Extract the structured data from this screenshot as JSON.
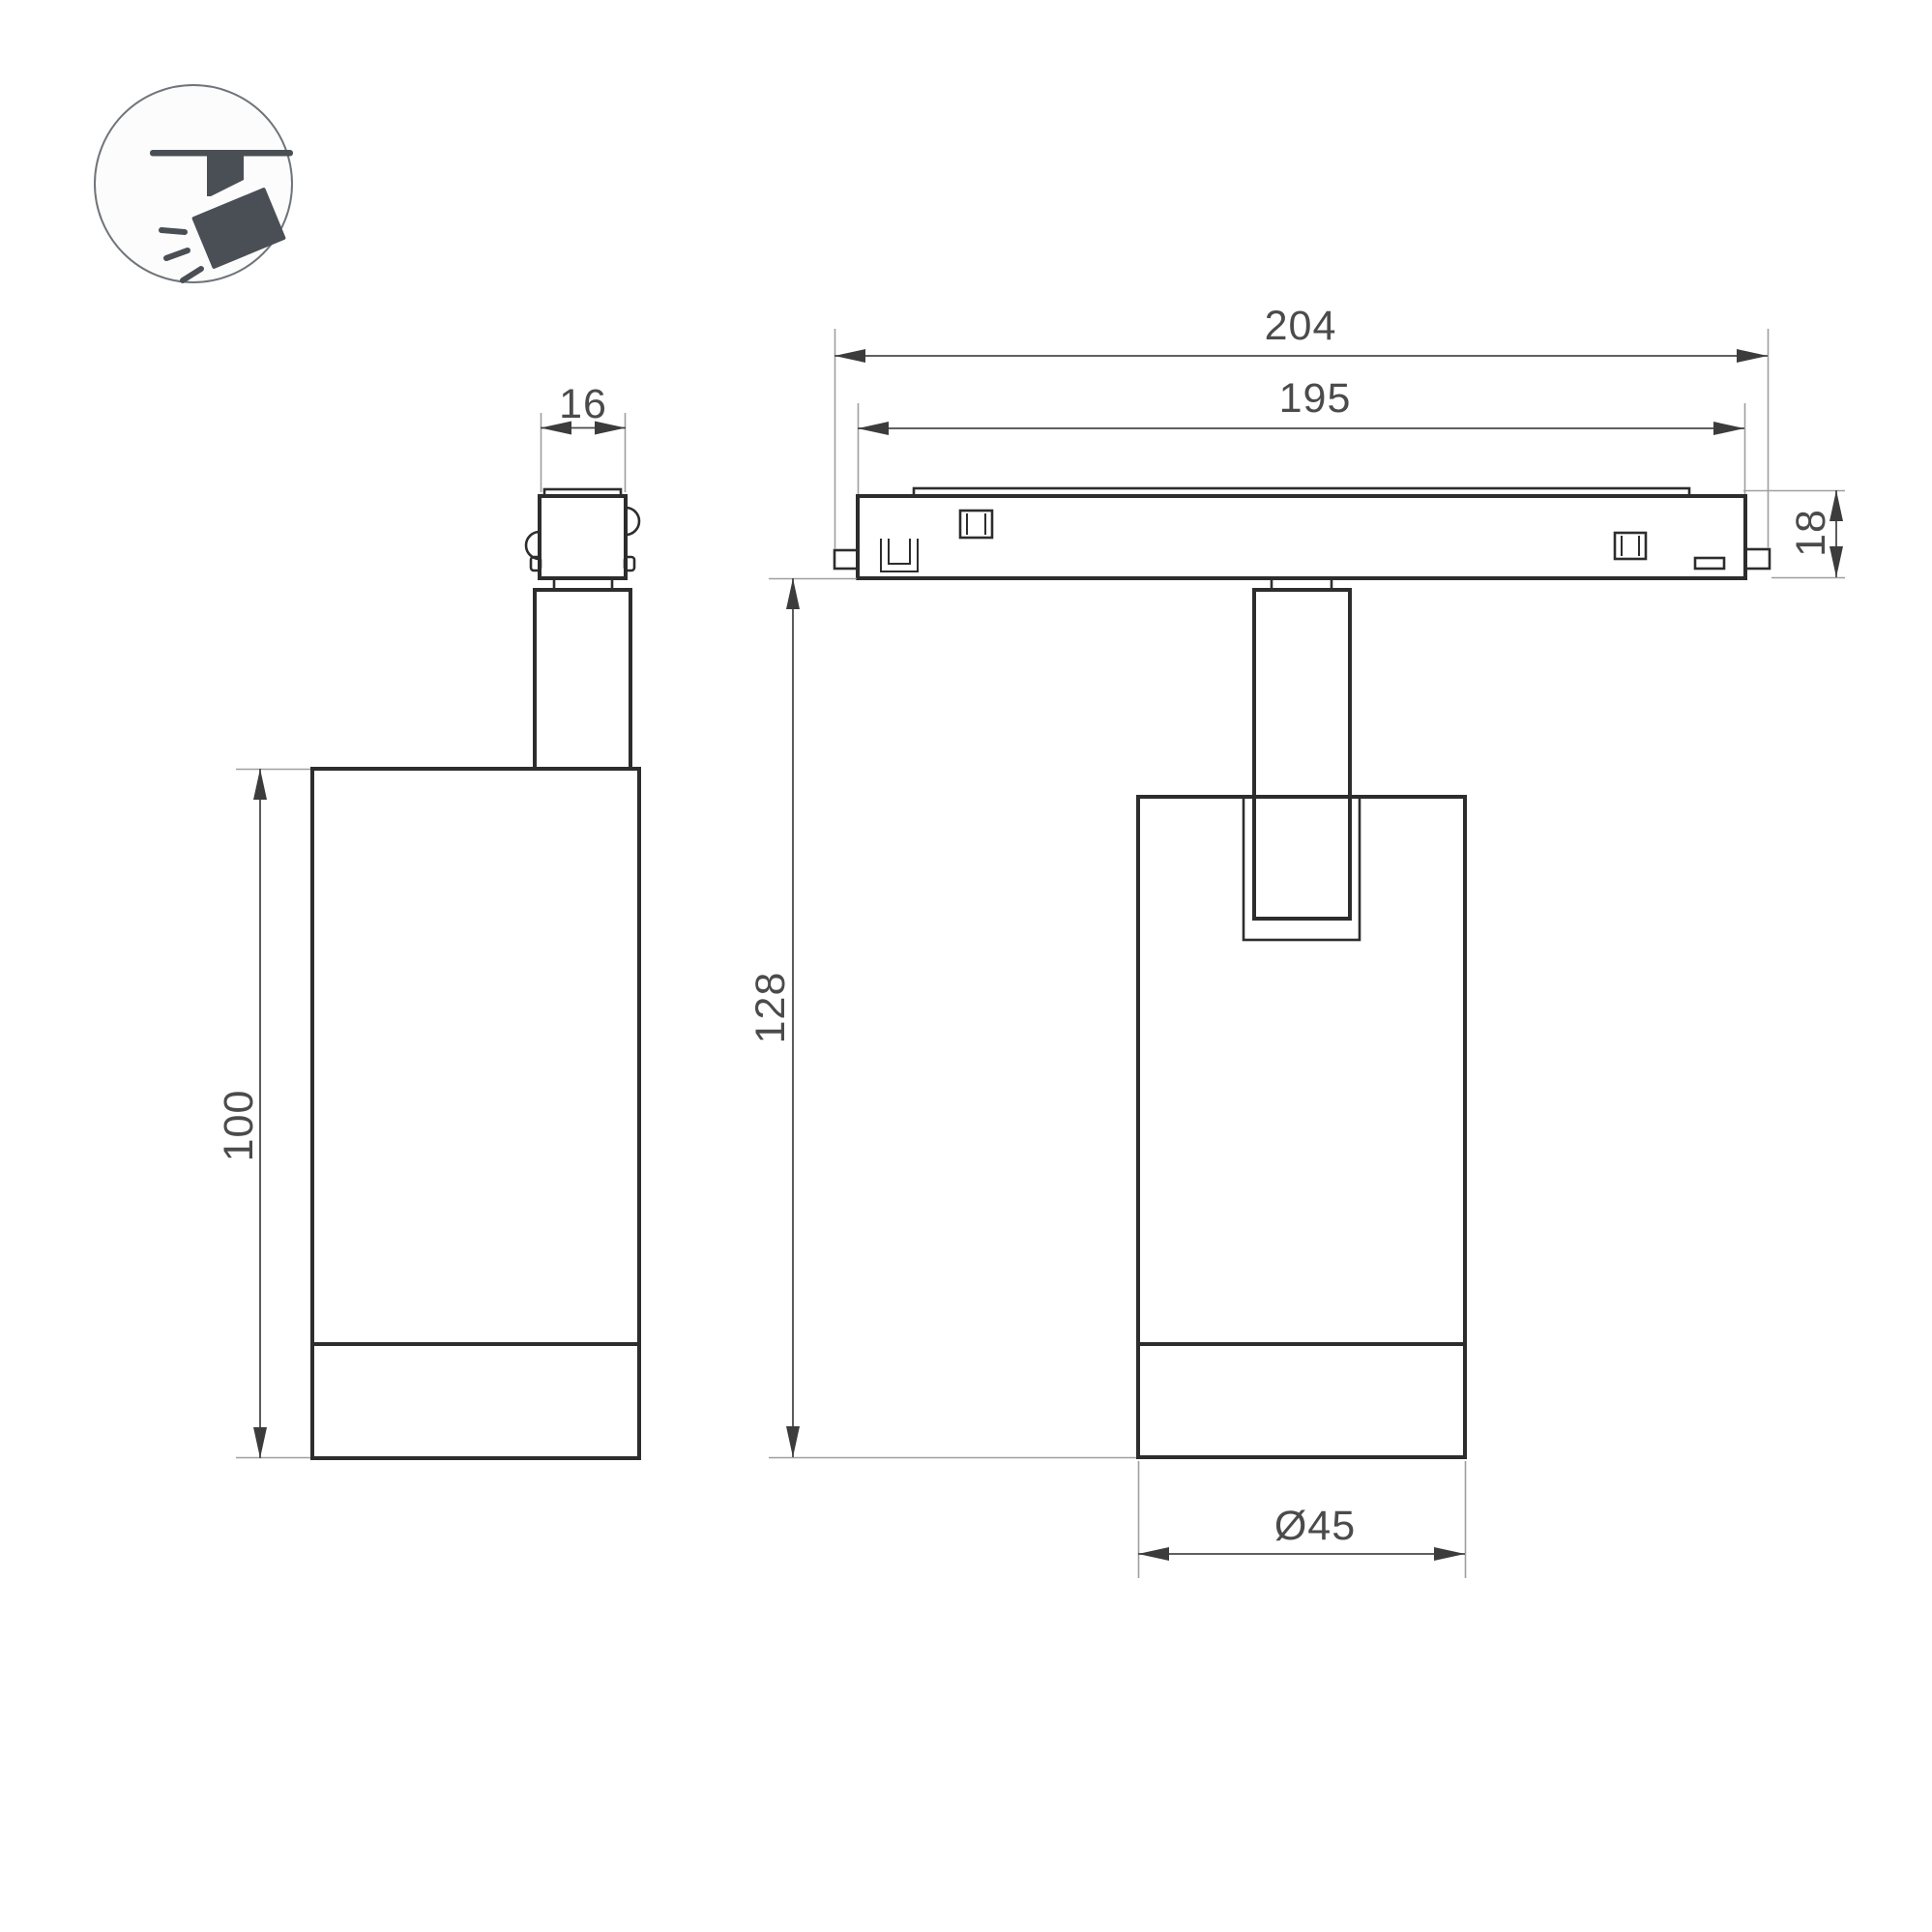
{
  "drawing": {
    "title": "track-spotlight-dimension-drawing",
    "icon": "ceiling-track-spotlight-icon",
    "dimensions": {
      "adapter_width": "16",
      "body_height": "100",
      "overall_length": "204",
      "track_length": "195",
      "track_height": "18",
      "overall_drop_height": "128",
      "body_diameter": "Ø45"
    }
  }
}
